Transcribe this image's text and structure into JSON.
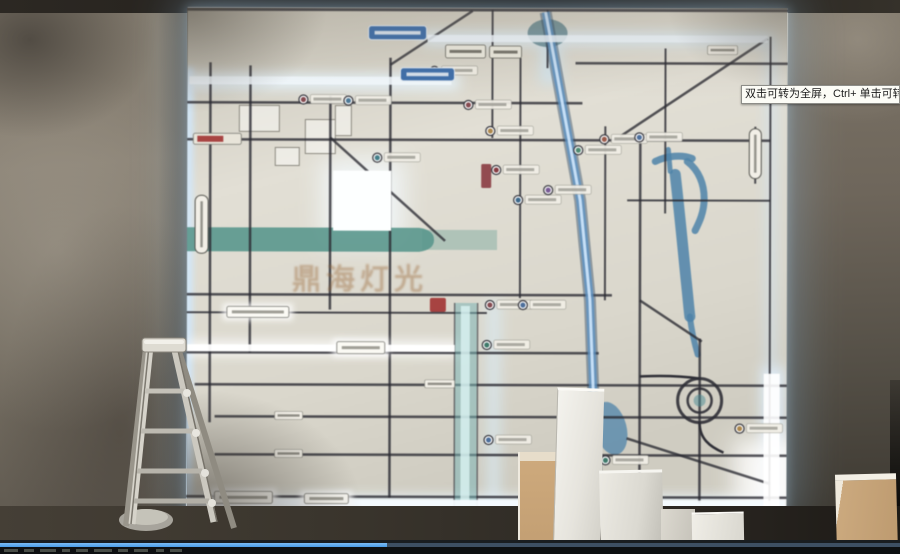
{
  "video_player": {
    "tooltip_text": "双击可转为全屏，Ctrl+ 单击可转为",
    "seek_filled_percent": 43,
    "seek_filled_color": "#4a9ce8",
    "seek_track_color": "#3d4f63",
    "control_remnants": [
      [
        4,
        14
      ],
      [
        24,
        10
      ],
      [
        40,
        16
      ],
      [
        62,
        8
      ],
      [
        76,
        12
      ],
      [
        94,
        18
      ],
      [
        118,
        10
      ],
      [
        134,
        14
      ],
      [
        156,
        8
      ],
      [
        170,
        12
      ]
    ]
  },
  "watermark_text": "鼎海灯光",
  "map_art": {
    "colors": {
      "background_top": "#c9c5b8",
      "background_mid": "#e2dfd4",
      "background_bottom": "#cfccc0",
      "road": "#2b2b33",
      "river": "#55988d",
      "water": "#4a84ad",
      "glow": "#cfe8ff",
      "blue_road": "#5a93c8",
      "label_fill": "#f2efe6",
      "blue_sign": "#3a6fb0",
      "red": "#a83030"
    },
    "glows": [
      [
        -4,
        60,
        10,
        444,
        "#cfe8ff",
        0.85,
        "b3"
      ],
      [
        0,
        66,
        272,
        16,
        "#e8f6ff",
        0.9,
        "b6"
      ],
      [
        235,
        24,
        350,
        13,
        "#dff2ff",
        0.85,
        "b6"
      ],
      [
        0,
        334,
        274,
        13,
        "#ffffff",
        0.95,
        "b6"
      ],
      [
        0,
        488,
        600,
        14,
        "#eaf8ff",
        0.95,
        "b6"
      ],
      [
        574,
        358,
        24,
        145,
        "#dfefff",
        0.85,
        "b6"
      ],
      [
        578,
        30,
        12,
        330,
        "#cfe4f8",
        0.5,
        "b6"
      ],
      [
        300,
        292,
        14,
        206,
        "#d8eefc",
        0.6,
        "b6"
      ],
      [
        135,
        152,
        82,
        84,
        "#f4fbff",
        0.8,
        "b12"
      ],
      [
        548,
        430,
        80,
        74,
        "#ffffff",
        0.85,
        "b12"
      ],
      [
        352,
        30,
        22,
        46,
        "#cfe8f8",
        0.7,
        "b6"
      ]
    ],
    "glow_cores": [
      [
        0,
        337,
        268,
        7,
        "#ffffff",
        0.95
      ],
      [
        2,
        69,
        262,
        8,
        "#f2faff",
        0.9
      ],
      [
        240,
        27,
        340,
        7,
        "#eef7ff",
        0.85
      ],
      [
        0,
        492,
        598,
        7,
        "#f4fbff",
        0.95
      ],
      [
        146,
        163,
        58,
        60,
        "#fdffff",
        1
      ],
      [
        577,
        365,
        16,
        135,
        "#ffffff",
        0.9
      ]
    ],
    "river_left_band": "M0,220 H232 Q247,222 247,232 Q247,242 232,244 H0 Z",
    "river_left_ext": [
      235,
      222,
      75,
      20
    ],
    "river_paths": [
      [
        "M468,153 C480,147 495,146 505,150",
        7
      ],
      [
        "M481,141 L483,163",
        5
      ],
      [
        "M500,153 C512,162 517,176 517,190 C517,204 512,214 508,222",
        7
      ],
      [
        "M488,166 C492,200 496,240 499,270 C501,288 502,300 503,308",
        11
      ],
      [
        "M503,308 C505,324 508,336 511,346",
        6
      ]
    ],
    "pools": [
      [
        424,
        420,
        16,
        27,
        -15
      ],
      [
        405,
        398,
        8,
        14,
        0
      ]
    ],
    "blob": [
      360,
      25,
      20,
      14
    ],
    "buildings": [
      [
        52,
        98,
        40,
        26
      ],
      [
        118,
        112,
        30,
        34
      ],
      [
        88,
        140,
        24,
        18
      ],
      [
        148,
        98,
        16,
        30
      ]
    ],
    "roads_h": [
      [
        2,
        0,
        600,
        3
      ],
      [
        55,
        388,
        600,
        2.5
      ],
      [
        95,
        0,
        395,
        2.5
      ],
      [
        132,
        0,
        583,
        2.5
      ],
      [
        192,
        440,
        583,
        2
      ],
      [
        287,
        0,
        425,
        2.5
      ],
      [
        305,
        0,
        300,
        2
      ],
      [
        345,
        0,
        412,
        2.5
      ],
      [
        377,
        8,
        600,
        2.5
      ],
      [
        409,
        28,
        600,
        2.5
      ],
      [
        447,
        28,
        600,
        2.5
      ],
      [
        489,
        0,
        600,
        2.5
      ]
    ],
    "roads_v": [
      [
        23,
        55,
        415,
        2.5
      ],
      [
        63,
        58,
        345,
        2.5
      ],
      [
        143,
        88,
        302,
        2.5
      ],
      [
        203,
        50,
        490,
        2.5
      ],
      [
        305,
        2,
        130,
        2
      ],
      [
        333,
        50,
        290,
        2
      ],
      [
        360,
        2,
        60,
        2
      ],
      [
        418,
        118,
        292,
        2
      ],
      [
        453,
        128,
        495,
        2.5
      ],
      [
        478,
        40,
        205,
        2
      ],
      [
        513,
        330,
        495,
        2.5
      ],
      [
        568,
        118,
        175,
        2
      ],
      [
        583,
        28,
        500,
        2
      ]
    ],
    "roads_d": [
      [
        203,
        57,
        285,
        3,
        2.5
      ],
      [
        143,
        130,
        258,
        233,
        2.5
      ],
      [
        433,
        128,
        580,
        30,
        2.5
      ],
      [
        453,
        292,
        515,
        333,
        2.5
      ],
      [
        440,
        430,
        583,
        475,
        2.5
      ]
    ],
    "blue_road_points": "358,4 393,192 403,292 411,495",
    "teal_column": [
      268,
      295,
      22,
      205
    ],
    "spiral": [
      513,
      392
    ],
    "pois": [
      [
        116,
        92,
        "#8a4a50"
      ],
      [
        161,
        93,
        "#4a7a9a"
      ],
      [
        190,
        150,
        "#3f7f8a"
      ],
      [
        247,
        63,
        "#4a6fa0"
      ],
      [
        281,
        97,
        "#8a4a50"
      ],
      [
        303,
        123,
        "#b08848"
      ],
      [
        309,
        162,
        "#8a3a40"
      ],
      [
        331,
        192,
        "#3a6a90"
      ],
      [
        361,
        182,
        "#7a5a9a"
      ],
      [
        391,
        142,
        "#4a8a70"
      ],
      [
        417,
        131,
        "#a05a48"
      ],
      [
        452,
        129,
        "#4a6fa0"
      ],
      [
        303,
        297,
        "#8a4a50"
      ],
      [
        300,
        337,
        "#3a7a6a"
      ],
      [
        336,
        297,
        "#4a6fa0"
      ],
      [
        419,
        452,
        "#3a7a6a"
      ],
      [
        553,
        420,
        "#b08848"
      ],
      [
        302,
        432,
        "#4a6fa0"
      ]
    ],
    "labels_white_glow": [
      [
        150,
        334,
        48,
        12
      ],
      [
        28,
        484,
        58,
        12
      ],
      [
        118,
        486,
        44,
        10
      ],
      [
        40,
        299,
        62,
        11
      ]
    ],
    "labels_small": [
      [
        88,
        404,
        28,
        8
      ],
      [
        88,
        442,
        28,
        8
      ],
      [
        238,
        372,
        30,
        8
      ],
      [
        520,
        37,
        30,
        9
      ]
    ],
    "signs_blue": [
      [
        181,
        18,
        58,
        14
      ],
      [
        213,
        60,
        54,
        13
      ]
    ],
    "signs_white": [
      [
        258,
        37,
        40,
        13
      ],
      [
        302,
        38,
        32,
        12
      ]
    ],
    "ovals_vertical": [
      [
        8,
        188,
        13,
        58
      ],
      [
        562,
        120,
        12,
        50
      ]
    ],
    "red_pill": [
      6,
      126,
      48,
      11
    ],
    "red_marker": [
      243,
      290,
      16,
      14
    ],
    "red_vertical_sign": [
      294,
      156,
      10,
      24
    ]
  }
}
